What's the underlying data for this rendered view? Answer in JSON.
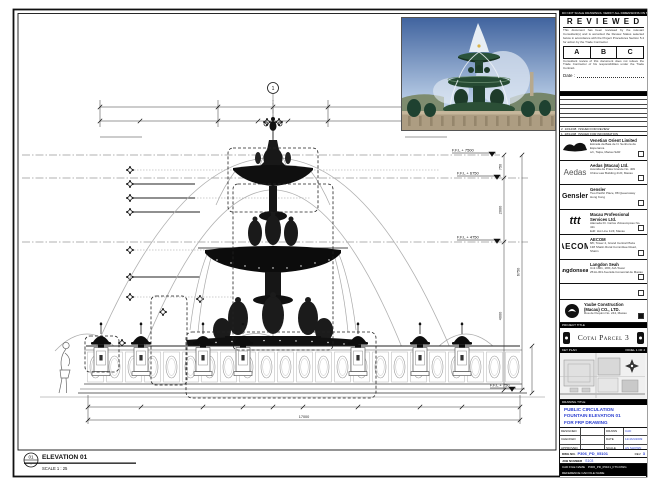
{
  "drawing": {
    "grid_bubble": "1",
    "levels": {
      "l1": "F.F.L + 7500",
      "l2": "F.F.L + 6750",
      "l3": "F.F.L + 4750",
      "l4": "F.F.L + 750"
    },
    "dims": {
      "d1": "750",
      "d2": "2000",
      "d3": "4000",
      "total": "6750",
      "overall": "17000"
    },
    "elevation": {
      "bubble_top": "01",
      "bubble_bottom": "-",
      "label": "ELEVATION 01",
      "scale": "SCALE 1 : 25"
    }
  },
  "strip": {
    "note": "DO NOT SCALE DRAWINGS. VERIFY ALL DIMENSIONS ON SITE PRIOR TO WORK",
    "stamp": {
      "title": "R E V I E W E D",
      "para1": "This document has been reviewed by the relevant Consultant(s) and is accorded the Review Status selected below in accordance with the Project Procedures Section 5.4 for action by the Trade Contractor.",
      "grade_a": "A",
      "grade_b": "B",
      "grade_c": "C",
      "para2": "Consultant review of this document does not relieve the Trade Contractor of his responsibilities under the Trade Contract.",
      "date_label": "Date :"
    },
    "rev": {
      "r1_no": "2",
      "r1_date": "10/12/08",
      "r1_desc": "ISSUED FOR REVIEW",
      "r2_no": "1",
      "r2_date": "28/11/08",
      "r2_desc": "ISSUED FOR INFORMATION",
      "h_no": "NO.",
      "h_date": "DATE",
      "h_desc": "DESCRIPTION",
      "h_by": "BY"
    },
    "consultants": [
      {
        "name": "Venetian Orient Limited",
        "line1": "Estrada da Baia de N. Senhora da Esperanca",
        "line2": "s/n, Taipa, Macau SAR"
      },
      {
        "logo_text": "Aedas",
        "name": "Aedas (Macau) Ltd.",
        "line1": "Avenida da Praia Grande No. 409",
        "line2": "China Law Building 21/F, Macau"
      },
      {
        "logo_text": "Gensler",
        "name": "Gensler",
        "line1": "Two Pacific Place, 88 Queensway",
        "line2": "Hong Kong"
      },
      {
        "logo_text": "ttt",
        "name": "Macau Professional Services Ltd.",
        "line1": "Alameda Dr. Carlos d'Assumpcao No. 411",
        "line2": "Edif. Hot Line 11/F, Macau"
      },
      {
        "logo_text": "AECOM",
        "name": "AECOM",
        "line1": "8/F, Tower 2, Grand Central Plaza",
        "line2": "138 Shatin Rural Committee Road, Shatin"
      },
      {
        "logo_text": "langdonseah",
        "name": "Langdon Seah",
        "line1": "Unit 1801, 18/F, AIA Tower",
        "line2": "251A-301 Avenida Comercial de Macau"
      }
    ],
    "contractor": {
      "name": "Yaube Construction",
      "name2": "(Macau) CO., LTD.",
      "line1": "Rua de Pequim No. 244, Macau"
    },
    "project": {
      "label": "PROJECT TITLE",
      "title": "Cotai Parcel 3"
    },
    "key_plan": {
      "label": "KEY PLAN",
      "panel": "PANEL 1 OF 4"
    },
    "title_block": {
      "label": "DRAWING TITLE",
      "line1": "PUBLIC CIRCULATION",
      "line2": "FOUNTAIN ELEVATION 01",
      "line3": "FOR FRP DRAWING"
    },
    "sign": {
      "designed": "DESIGNED",
      "checked": "CHECKED",
      "approved": "APPROVED",
      "drawn": "DRAWN",
      "date": "DATE",
      "scale": "SCALE",
      "designed_v": "",
      "checked_v": "-",
      "approved_v": "-",
      "drawn_v": "CAD",
      "date_v": "12/JAN/2009",
      "scale_v": "AS SHOWN"
    },
    "dwg": {
      "label": "DWG NO.",
      "value": "P306_PD_05101",
      "rev_label": "REV",
      "rev": "3",
      "job_label": "JOB NUMBER",
      "job": "S103",
      "cad_label": "CAD FILE NAME",
      "cad_value": "P306_PD_05101_FTN.DWG",
      "ref_label": "REFERENCE CAD FILE NAME"
    }
  },
  "colors": {
    "accent_blue": "#2b3fd0",
    "ink": "#111111",
    "fountain_green": "#24452f"
  }
}
